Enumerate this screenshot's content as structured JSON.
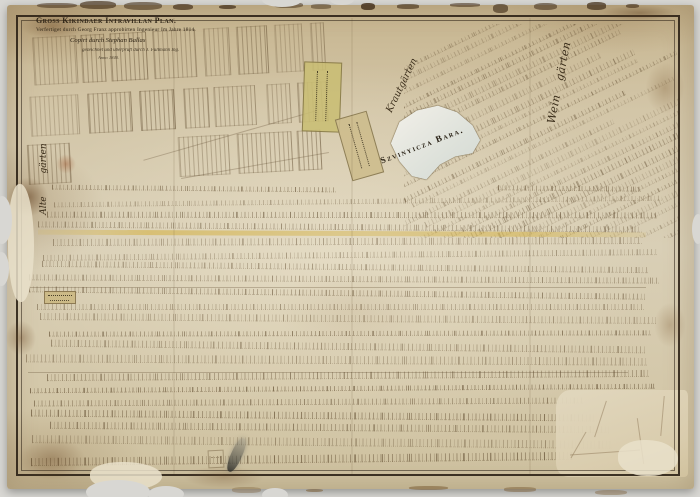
{
  "photo": {
    "background": "#d8d7d3"
  },
  "map": {
    "title_block": {
      "title": "Gross Kikindaer Intravillan Plan.",
      "line2": "Verfertiget durch Georg Franz approbirten Ingenieur Im Jahre 1814.",
      "line3": "Copirt durch Stephan Ballas",
      "line4": "gezeichnet und überprüft durch J. Füllmann Ing.",
      "line5": "Anno 1840."
    },
    "labels": {
      "marsh": "Szvinyicza Bara.",
      "vineyards": "Wein gärten",
      "cabbage_gardens": "Krautgärten",
      "old_gardens": "Alte gärten"
    },
    "colors": {
      "paper": "#d5c9ad",
      "border_ink": "#2e2418",
      "drawing_ink": "#6a5338",
      "water": "#e9e8e0",
      "street_highlight": "#d4b246",
      "parcel_olive": "#c9bd72",
      "parcel_tan": "#cdbd8d"
    }
  }
}
